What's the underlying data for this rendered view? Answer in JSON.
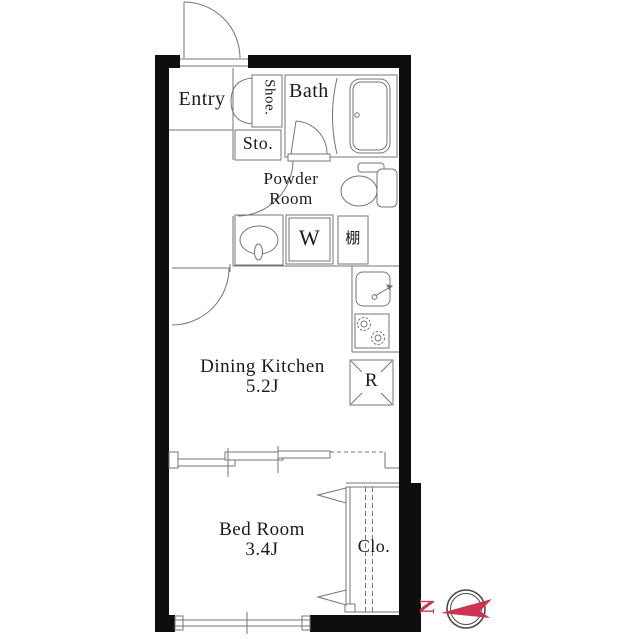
{
  "rooms": {
    "entry": {
      "label": "Entry"
    },
    "shoe_cabinet": {
      "label": "Shoe."
    },
    "bath": {
      "label": "Bath"
    },
    "storage": {
      "label": "Sto."
    },
    "powder_room": {
      "lines": [
        "Powder",
        "Room"
      ]
    },
    "dining_kitchen": {
      "label": "Dining Kitchen",
      "size": "5.2J"
    },
    "bedroom": {
      "label": "Bed Room",
      "size": "3.4J"
    },
    "closet": {
      "label": "Clo."
    }
  },
  "fixtures": {
    "washer_label": "W",
    "shelf_label": "棚",
    "refrigerator_label": "R"
  },
  "compass": {
    "north_label": "N"
  },
  "colors": {
    "wall": "#0e0e0e",
    "line": "#757575",
    "accent": "#ce3350",
    "compass_ring": "#4a4a4a"
  }
}
